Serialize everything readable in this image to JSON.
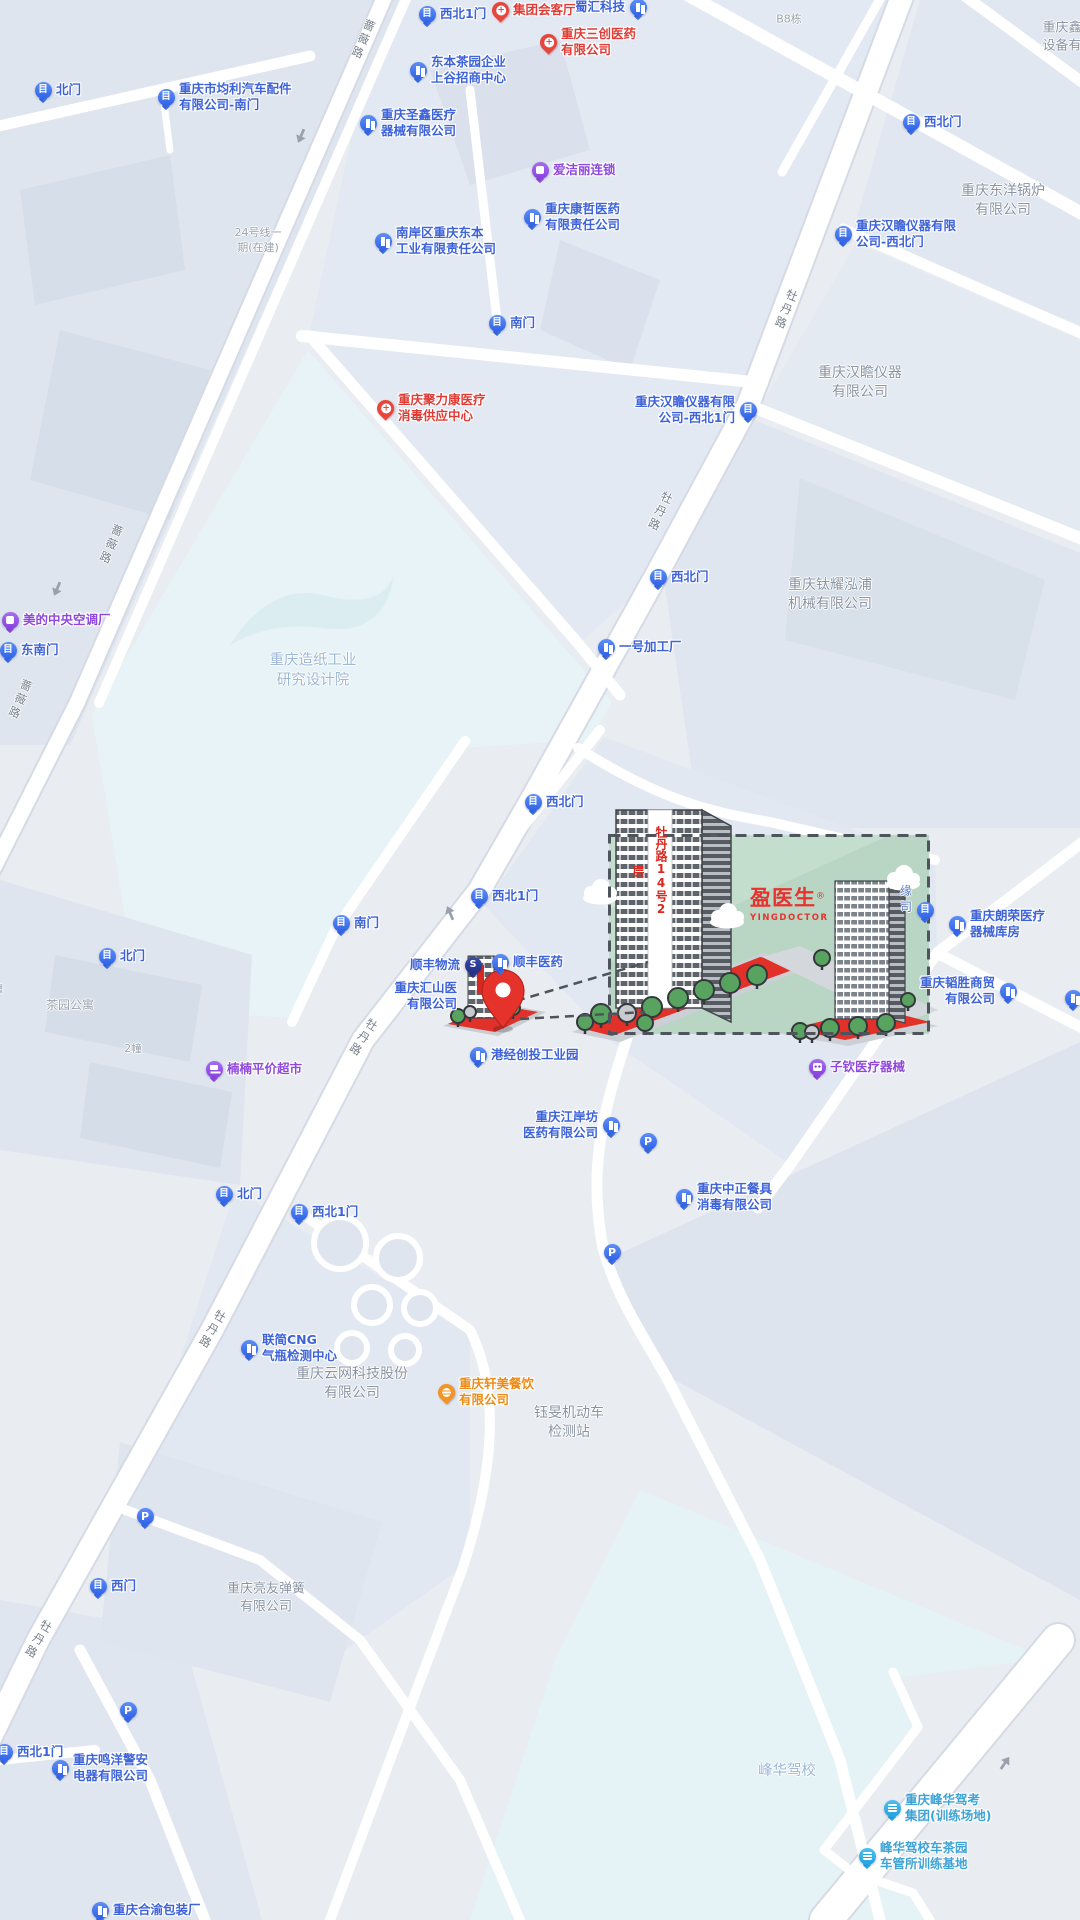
{
  "canvas": {
    "width": 1080,
    "height": 1920
  },
  "colors": {
    "background": "#e9edf2",
    "poi_blue": "#3e63d9",
    "medical_red": "#e03c35",
    "purple": "#8f49dd",
    "orange": "#ee8b17",
    "teal": "#3fa3d6",
    "area_gray": "#8a93a3",
    "area_blue": "#9db7d6",
    "highlight_green": "#b9d6c4",
    "plaza_red": "#e23128",
    "pin_red": "#e5332c"
  },
  "highlight": {
    "banner": "牡丹路14号2层",
    "logo": "盈医生",
    "logo_reg": "®",
    "logo_sub": "YINGDOCTOR"
  },
  "road_labels": [
    {
      "text": "蔷薇路",
      "x": 363,
      "y": 40,
      "rot": 23
    },
    {
      "text": "蔷薇路",
      "x": 111,
      "y": 545,
      "rot": 23
    },
    {
      "text": "蔷薇路",
      "x": 20,
      "y": 700,
      "rot": 23
    },
    {
      "text": "牡丹路",
      "x": 786,
      "y": 310,
      "rot": 22
    },
    {
      "text": "牡丹路",
      "x": 660,
      "y": 512,
      "rot": 25
    },
    {
      "text": "牡丹路",
      "x": 363,
      "y": 1038,
      "rot": 33
    },
    {
      "text": "牡丹路",
      "x": 212,
      "y": 1330,
      "rot": 30
    },
    {
      "text": "牡丹路",
      "x": 38,
      "y": 1640,
      "rot": 30
    }
  ],
  "area_labels": [
    {
      "lines": [
        "B8栋"
      ],
      "x": 789,
      "y": 20,
      "size": 11,
      "color": "#99a1ad"
    },
    {
      "lines": [
        "重庆鑫",
        "设备有"
      ],
      "x": 1062,
      "y": 37,
      "size": 13,
      "color": "#8a93a3"
    },
    {
      "lines": [
        "24号线一",
        "期(在建)"
      ],
      "x": 258,
      "y": 241,
      "size": 11,
      "color": "#9aa2ae"
    },
    {
      "lines": [
        "重庆东洋锅炉",
        "有限公司"
      ],
      "x": 1003,
      "y": 201,
      "size": 14,
      "color": "#8a93a3"
    },
    {
      "lines": [
        "重庆汉瞻仪器",
        "有限公司"
      ],
      "x": 860,
      "y": 383,
      "size": 14,
      "color": "#8a93a3"
    },
    {
      "lines": [
        "重庆钛耀泓浦",
        "机械有限公司"
      ],
      "x": 830,
      "y": 595,
      "size": 14,
      "color": "#8a93a3"
    },
    {
      "lines": [
        "重庆造纸工业",
        "研究设计院"
      ],
      "x": 313,
      "y": 671,
      "size": 14.5,
      "color": "#9db7d6"
    },
    {
      "lines": [
        "茶园公寓"
      ],
      "x": 70,
      "y": 1005,
      "size": 12,
      "color": "#99a1ad"
    },
    {
      "lines": [
        "幢"
      ],
      "x": -2,
      "y": 990,
      "size": 10,
      "color": "#99a1ad"
    },
    {
      "lines": [
        "2幢"
      ],
      "x": 133,
      "y": 1049,
      "size": 10.5,
      "color": "#99a1ad"
    },
    {
      "lines": [
        "重庆云网科技股份",
        "有限公司"
      ],
      "x": 352,
      "y": 1384,
      "size": 14,
      "color": "#8a93a3"
    },
    {
      "lines": [
        "钰旻机动车",
        "检测站"
      ],
      "x": 569,
      "y": 1423,
      "size": 14,
      "color": "#8a93a3"
    },
    {
      "lines": [
        "重庆亮友弹簧",
        "有限公司"
      ],
      "x": 266,
      "y": 1598,
      "size": 13,
      "color": "#8a93a3"
    },
    {
      "lines": [
        "峰华驾校"
      ],
      "x": 787,
      "y": 1772,
      "size": 14.5,
      "color": "#9db7d6"
    },
    {
      "lines": [
        "缘",
        "司"
      ],
      "x": 906,
      "y": 899,
      "size": 12,
      "color": "#5b79c8"
    }
  ],
  "pois": [
    {
      "icon": "gate",
      "lines": [
        "西北1门"
      ],
      "x": 427,
      "y": 14
    },
    {
      "icon": "gate",
      "lines": [
        "北门"
      ],
      "x": 43,
      "y": 90
    },
    {
      "icon": "gate",
      "lines": [
        "重庆市均利汽车配件",
        "有限公司-南门"
      ],
      "x": 166,
      "y": 97
    },
    {
      "icon": "gate",
      "lines": [
        "西北门"
      ],
      "x": 911,
      "y": 122
    },
    {
      "icon": "gate",
      "lines": [
        "重庆汉瞻仪器有限",
        "公司-西北门"
      ],
      "x": 843,
      "y": 234
    },
    {
      "icon": "gate",
      "lines": [
        "南门"
      ],
      "x": 497,
      "y": 323
    },
    {
      "icon": "gate",
      "lines": [
        "重庆汉瞻仪器有限",
        "公司-西北1门"
      ],
      "x": 748,
      "y": 410,
      "side": "left"
    },
    {
      "icon": "gate",
      "lines": [
        "西北门"
      ],
      "x": 658,
      "y": 577
    },
    {
      "icon": "gate",
      "lines": [
        "西北门"
      ],
      "x": 533,
      "y": 802
    },
    {
      "icon": "gate",
      "lines": [
        "西北1门"
      ],
      "x": 479,
      "y": 896
    },
    {
      "icon": "gate",
      "lines": [
        "南门"
      ],
      "x": 341,
      "y": 923
    },
    {
      "icon": "gate",
      "lines": [
        "东南门"
      ],
      "x": 8,
      "y": 650
    },
    {
      "icon": "gate",
      "lines": [
        "北门"
      ],
      "x": 107,
      "y": 956
    },
    {
      "icon": "gate",
      "lines": [
        "北门"
      ],
      "x": 224,
      "y": 1194
    },
    {
      "icon": "gate",
      "lines": [
        "西北1门"
      ],
      "x": 299,
      "y": 1212
    },
    {
      "icon": "gate",
      "lines": [
        "西门"
      ],
      "x": 98,
      "y": 1586
    },
    {
      "icon": "gate",
      "lines": [
        "西北1门"
      ],
      "x": 4,
      "y": 1752
    },
    {
      "icon": "gate",
      "lines": [],
      "x": 925,
      "y": 910
    },
    {
      "icon": "building",
      "lines": [
        "东本茶园企业",
        "上谷招商中心"
      ],
      "x": 418,
      "y": 70
    },
    {
      "icon": "building",
      "lines": [
        "蜀汇科技"
      ],
      "x": 638,
      "y": 7,
      "side": "left"
    },
    {
      "icon": "building",
      "lines": [
        "重庆圣鑫医疗",
        "器械有限公司"
      ],
      "x": 368,
      "y": 123
    },
    {
      "icon": "building",
      "lines": [
        "重庆康哲医药",
        "有限责任公司"
      ],
      "x": 532,
      "y": 217
    },
    {
      "icon": "building",
      "lines": [
        "南岸区重庆东本",
        "工业有限责任公司"
      ],
      "x": 383,
      "y": 241
    },
    {
      "icon": "building",
      "lines": [
        "一号加工厂"
      ],
      "x": 606,
      "y": 647
    },
    {
      "icon": "building",
      "lines": [
        "顺丰医药"
      ],
      "x": 500,
      "y": 962
    },
    {
      "icon": "building",
      "lines": [
        "港经创投工业园"
      ],
      "x": 478,
      "y": 1055
    },
    {
      "icon": "building",
      "lines": [
        "重庆江岸坊",
        "医药有限公司"
      ],
      "x": 611,
      "y": 1125,
      "side": "left"
    },
    {
      "icon": "building",
      "lines": [
        "重庆中正餐具",
        "消毒有限公司"
      ],
      "x": 684,
      "y": 1197
    },
    {
      "icon": "building",
      "lines": [
        "联简CNG",
        "气瓶检测中心"
      ],
      "x": 249,
      "y": 1348
    },
    {
      "icon": "building",
      "lines": [
        "重庆韬胜商贸",
        "有限公司"
      ],
      "x": 1008,
      "y": 991,
      "side": "left"
    },
    {
      "icon": "building",
      "lines": [
        "重庆朗荣医疗",
        "器械库房"
      ],
      "x": 957,
      "y": 924
    },
    {
      "icon": "building",
      "lines": [],
      "x": 1073,
      "y": 998
    },
    {
      "icon": "building",
      "lines": [
        "重庆鸣洋警安",
        "电器有限公司"
      ],
      "x": 60,
      "y": 1768
    },
    {
      "icon": "building",
      "lines": [
        "重庆合渝包装厂"
      ],
      "x": 100,
      "y": 1910
    },
    {
      "icon": "none",
      "lines": [
        "重庆汇山医",
        "有限公司"
      ],
      "x": 470,
      "y": 996,
      "side": "left"
    },
    {
      "icon": "medical",
      "lines": [
        "集团会客厅"
      ],
      "x": 500,
      "y": 10
    },
    {
      "icon": "medical",
      "lines": [
        "重庆三创医药",
        "有限公司"
      ],
      "x": 548,
      "y": 42
    },
    {
      "icon": "medical",
      "lines": [
        "重庆聚力康医疗",
        "消毒供应中心"
      ],
      "x": 385,
      "y": 408
    },
    {
      "icon": "clean",
      "lines": [
        "爱洁丽连锁"
      ],
      "x": 540,
      "y": 170
    },
    {
      "icon": "ac",
      "lines": [
        "美的中央空调厂"
      ],
      "x": 10,
      "y": 620
    },
    {
      "icon": "cart",
      "lines": [
        "楠楠平价超市"
      ],
      "x": 214,
      "y": 1069
    },
    {
      "icon": "med2",
      "lines": [
        "子钦医疗器械"
      ],
      "x": 817,
      "y": 1067
    },
    {
      "icon": "parking",
      "lines": [],
      "x": 648,
      "y": 1141
    },
    {
      "icon": "parking",
      "lines": [],
      "x": 612,
      "y": 1252
    },
    {
      "icon": "parking",
      "lines": [],
      "x": 145,
      "y": 1516
    },
    {
      "icon": "parking",
      "lines": [],
      "x": 128,
      "y": 1710
    },
    {
      "icon": "food",
      "lines": [
        "重庆轩美餐饮",
        "有限公司"
      ],
      "x": 446,
      "y": 1392
    },
    {
      "icon": "school",
      "lines": [
        "重庆峰华驾考",
        "集团(训练场地)"
      ],
      "x": 892,
      "y": 1808
    },
    {
      "icon": "school",
      "lines": [
        "峰华驾校车茶园",
        "车管所训练基地"
      ],
      "x": 867,
      "y": 1856
    },
    {
      "icon": "sf",
      "lines": [
        "顺丰物流"
      ],
      "x": 473,
      "y": 965,
      "side": "left"
    }
  ],
  "arrows": [
    {
      "x": 301,
      "y": 136,
      "rot": 113
    },
    {
      "x": 57,
      "y": 589,
      "rot": 113
    },
    {
      "x": 450,
      "y": 913,
      "rot": -113
    },
    {
      "x": 1005,
      "y": 1763,
      "rot": -55
    }
  ]
}
